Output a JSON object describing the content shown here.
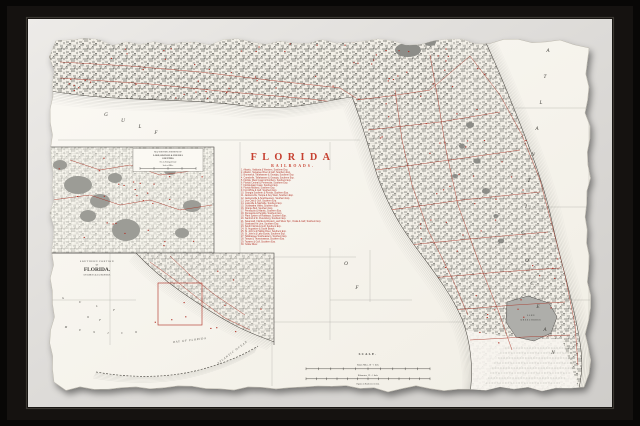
{
  "artwork": {
    "title": "FLORIDA",
    "subtitle": "RAILROADS.",
    "railroads": [
      "Atlantic, Valdosta & Western, Southern Exp.",
      "Atlantic, Suwanee River & Gulf, Southern Exp.",
      "Brunswick, Tallahassee & Georgia, Southern Exp.",
      "Carrabelle, Tallahassee & Georgia, Southern Exp.",
      "Florida, West Coast & Northern, Southern Exp.",
      "Florida Central & Peninsular, Southern Exp.",
      "Florida East Coast, Southern Exp.",
      "Florida Midland, Southern Exp.",
      "Fort White & Gulf, Southern Exp.",
      "Georgia Southern & Florida, Southern Exp.",
      "Jacksonville, Tampa & Key West, Southern Exp.",
      "Jacksonville & Southwestern, Southern Exp.",
      "Live Oak & Gulf, Southern Exp.",
      "Louisville & Nashville, Southern Exp.",
      "Ocklawaha Valley, Southern Exp.",
      "Orange Belt, Southern Exp.",
      "Pensacola & Atlantic, Southern Exp.",
      "Pensacola & Perdido, Southern Exp.",
      "Plant System of Railways, Southern Exp.",
      "Sanford & St. Petersburg, Southern Exp.",
      "Savannah, Florida & Western, and Silver Spr., Ocala & Gulf, Southern Exp.",
      "Seaboard Air Line, Southern Exp.",
      "South Florida & Gulf, Southern Exp.",
      "St. Augustine & South Beach.",
      "St. John's & Halifax River, Southern Exp.",
      "St. John's & Lake Eustis, Southern Exp.",
      "Tallahassee Southeastern, Southern Exp.",
      "Tampa & Thonotosassa, Southern Exp.",
      "Tavares & Gulf, Southern Exp.",
      "Yellow River."
    ],
    "sea_main": {
      "gulf": "GULF",
      "of": "OF",
      "atlantic": "ATLANTIC",
      "ocean": "OCEAN"
    },
    "lake_label": {
      "line1": "LAKE",
      "line2": "OKEECHOBEE"
    },
    "inset_enlarged": {
      "title_lines": [
        "MAP SHOWING PORTIONS OF",
        "LAKE, ORANGE & VOLUSIA",
        "COUNTIES.",
        "On an Enlarged Scale",
        "Scale of Miles"
      ]
    },
    "inset_southern": {
      "title_lines": [
        "SOUTHERN PORTION",
        "OF",
        "FLORIDA.",
        "ON SAME SCALE AS MAIN MAP."
      ],
      "sea_words": {
        "gulf": "GULF",
        "of": "OF",
        "mexico": "MEXICO"
      },
      "bay_label": "BAY OF FLORIDA",
      "ocean_label": "ATLANTIC OCEAN"
    },
    "scale": {
      "title": "SCALE.",
      "miles_label": "Statute Miles, 18 = 1 Inch.",
      "km_label": "Kilometres, 29 = 1 Inch.",
      "caption": "Figures on Roads refer to List."
    }
  },
  "colors": {
    "frame": "#151210",
    "mat": "#e2e0dd",
    "paper": "#faf8f1",
    "accent_red": "#b2352a",
    "title_red": "#c63f2f",
    "engraving_gray": "#72726d"
  }
}
